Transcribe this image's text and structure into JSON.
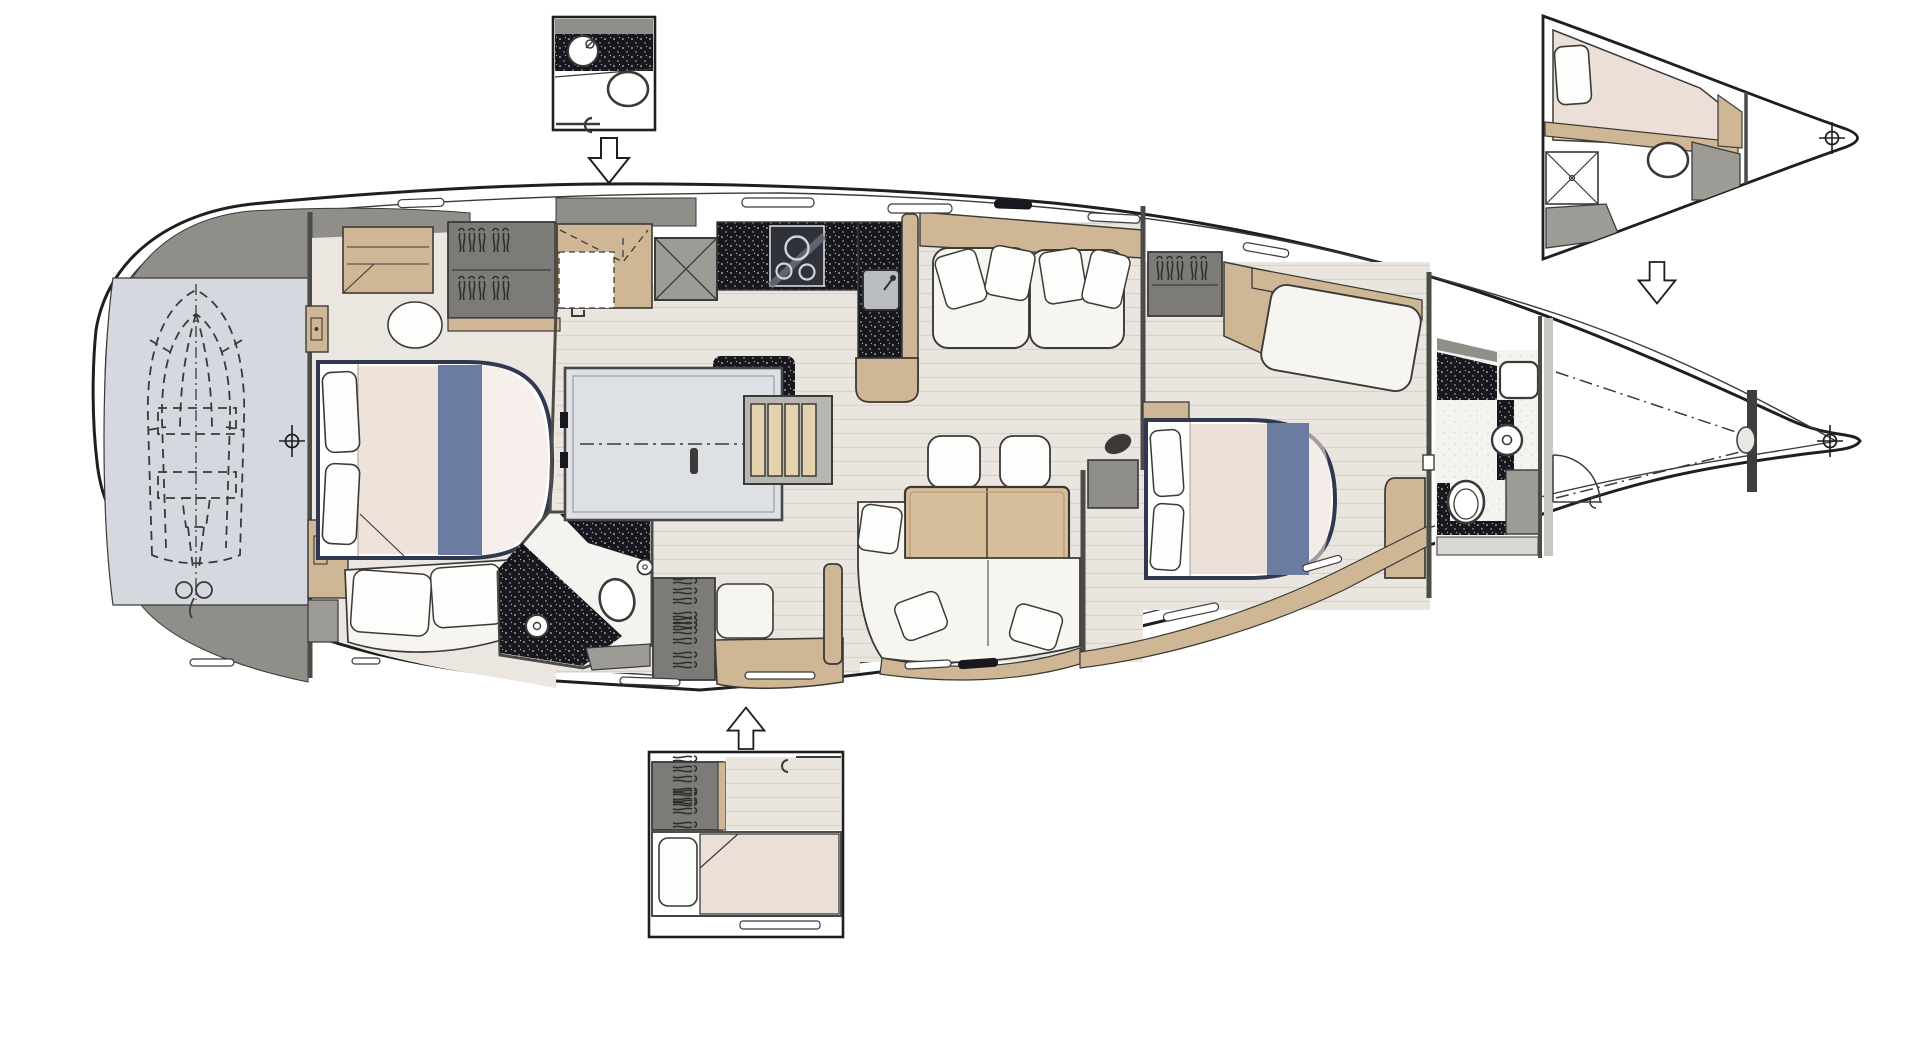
{
  "diagram": {
    "type": "floor-plan",
    "subject": "sailing-yacht interior deck plan, top view, bow to the right",
    "text_labels": [],
    "main_plan": {
      "rooms": [
        {
          "name": "tender-garage",
          "features": [
            "dinghy-dashed-outline",
            "outboard-motor",
            "datum-crosshair"
          ]
        },
        {
          "name": "aft-owners-cabin",
          "features": [
            "double-bed-blue-runner",
            "dresser",
            "wardrobe-hangers",
            "sofa",
            "stool"
          ]
        },
        {
          "name": "aft-head",
          "features": [
            "shower-drain",
            "toilet",
            "black-counter"
          ]
        },
        {
          "name": "galley",
          "features": [
            "stove-3-burners",
            "sink",
            "black-speckled-counters"
          ]
        },
        {
          "name": "companionway",
          "features": [
            "engine-compartment-hatch",
            "steps-4-treads"
          ]
        },
        {
          "name": "salon",
          "features": [
            "port-settee-4-pillows",
            "table-2-leaves",
            "2-stools",
            "u-settee"
          ]
        },
        {
          "name": "forward-cabin",
          "features": [
            "island-bed-blue-runner",
            "sofa",
            "wardrobe-hangers",
            "vanity"
          ]
        },
        {
          "name": "forward-head",
          "features": [
            "washbasin",
            "toilet",
            "toilet-roll",
            "shower-locker"
          ]
        },
        {
          "name": "bow-sail-locker",
          "features": [
            "access-door",
            "dash-dot-lines",
            "windlass-bulkhead",
            "datum-crosshair"
          ]
        }
      ]
    },
    "insets": [
      {
        "name": "aft-head-option",
        "position": "top-left",
        "connector": "arrow-down-icon",
        "features": [
          "washbasin",
          "toilet",
          "black-counter"
        ]
      },
      {
        "name": "bow-crew-cabin-option",
        "position": "top-right",
        "connector": "arrow-down-icon",
        "features": [
          "berth-with-pillow",
          "shower",
          "toilet",
          "datum-crosshair"
        ]
      },
      {
        "name": "aft-cabin-option",
        "position": "bottom-center",
        "connector": "arrow-up-icon",
        "features": [
          "single-berth-with-pillow",
          "wardrobe-hangers",
          "wood-floor"
        ]
      }
    ],
    "symbols": {
      "datum_crosshairs": 3,
      "direction_arrows": 3,
      "hanger_clusters": 5
    }
  },
  "colors": {
    "outline": "#1f1f1f",
    "wall": "#4c4b47",
    "furn": "#3a3a38",
    "white": "#ffffff",
    "deckGray": "#908e89",
    "garage": "#d6d8e0",
    "carpet": "#ebe6e0",
    "woodFloor": "#eae6df",
    "plankLine": "#d7d2c8",
    "trimWood": "#cfb795",
    "trimWoodLight": "#e5d3ad",
    "counterBlack": "#17171d",
    "cushion": "#f6f5f0",
    "pillow": "#fdfdfb",
    "mattress": "#eee2da",
    "mattressPink": "#ecdfd8",
    "runnerBlue": "#6b7ca1",
    "navyTrim": "#323850",
    "engineBox": "#dde0e5",
    "grayBox": "#9d9b96",
    "grayBoxDark": "#7c7b77",
    "lightFloor": "#f4f3f0",
    "shadeGray": "#c9c7c3",
    "sinkGray": "#b9bcc0",
    "stoveDark": "#2f323a"
  }
}
